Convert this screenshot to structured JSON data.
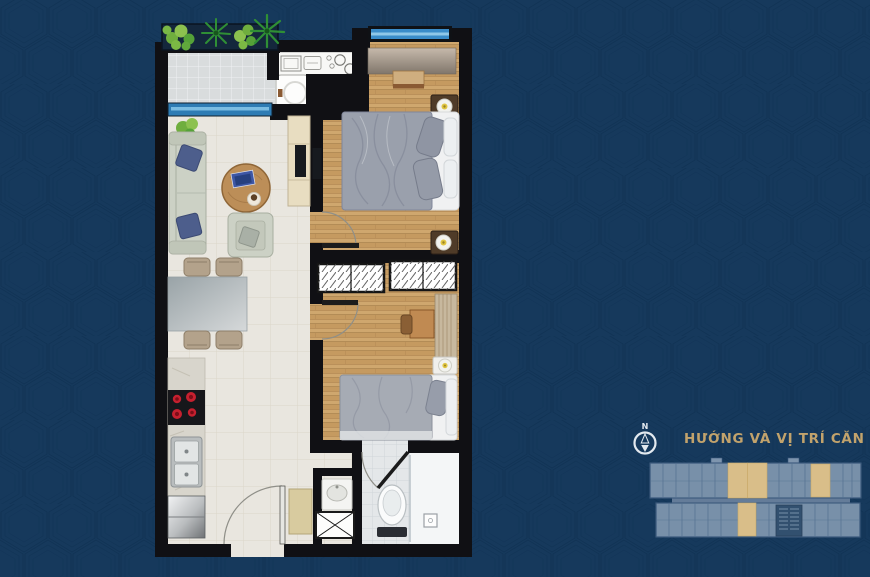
{
  "sidebar": {
    "compass_label": "N",
    "title": "HƯỚNG VÀ VỊ TRÍ CĂN HỘ"
  },
  "minimap": {
    "highlighted_units_top_row": 3,
    "highlighted_units_bottom_row": 1
  },
  "palette": {
    "bg_navy": "#16395c",
    "pattern_line": "#0c2d4e",
    "wall": "#101014",
    "title_gold": "#c2a36c",
    "compass": "#e3e9ef",
    "window_blue": "#3a8cc9",
    "window_blue_light": "#8fc7e8",
    "wood_floor": "#cfa76e",
    "living_tile": "#e9e6df",
    "balcony_tile": "#dadddd",
    "bath_tile": "#e4e7e9",
    "mini_base": "#7e95ae",
    "mini_outline": "#3c5a7d",
    "mini_unit_line": "#52708f",
    "mini_highlight": "#d9be89",
    "mini_core": "#32506f"
  }
}
